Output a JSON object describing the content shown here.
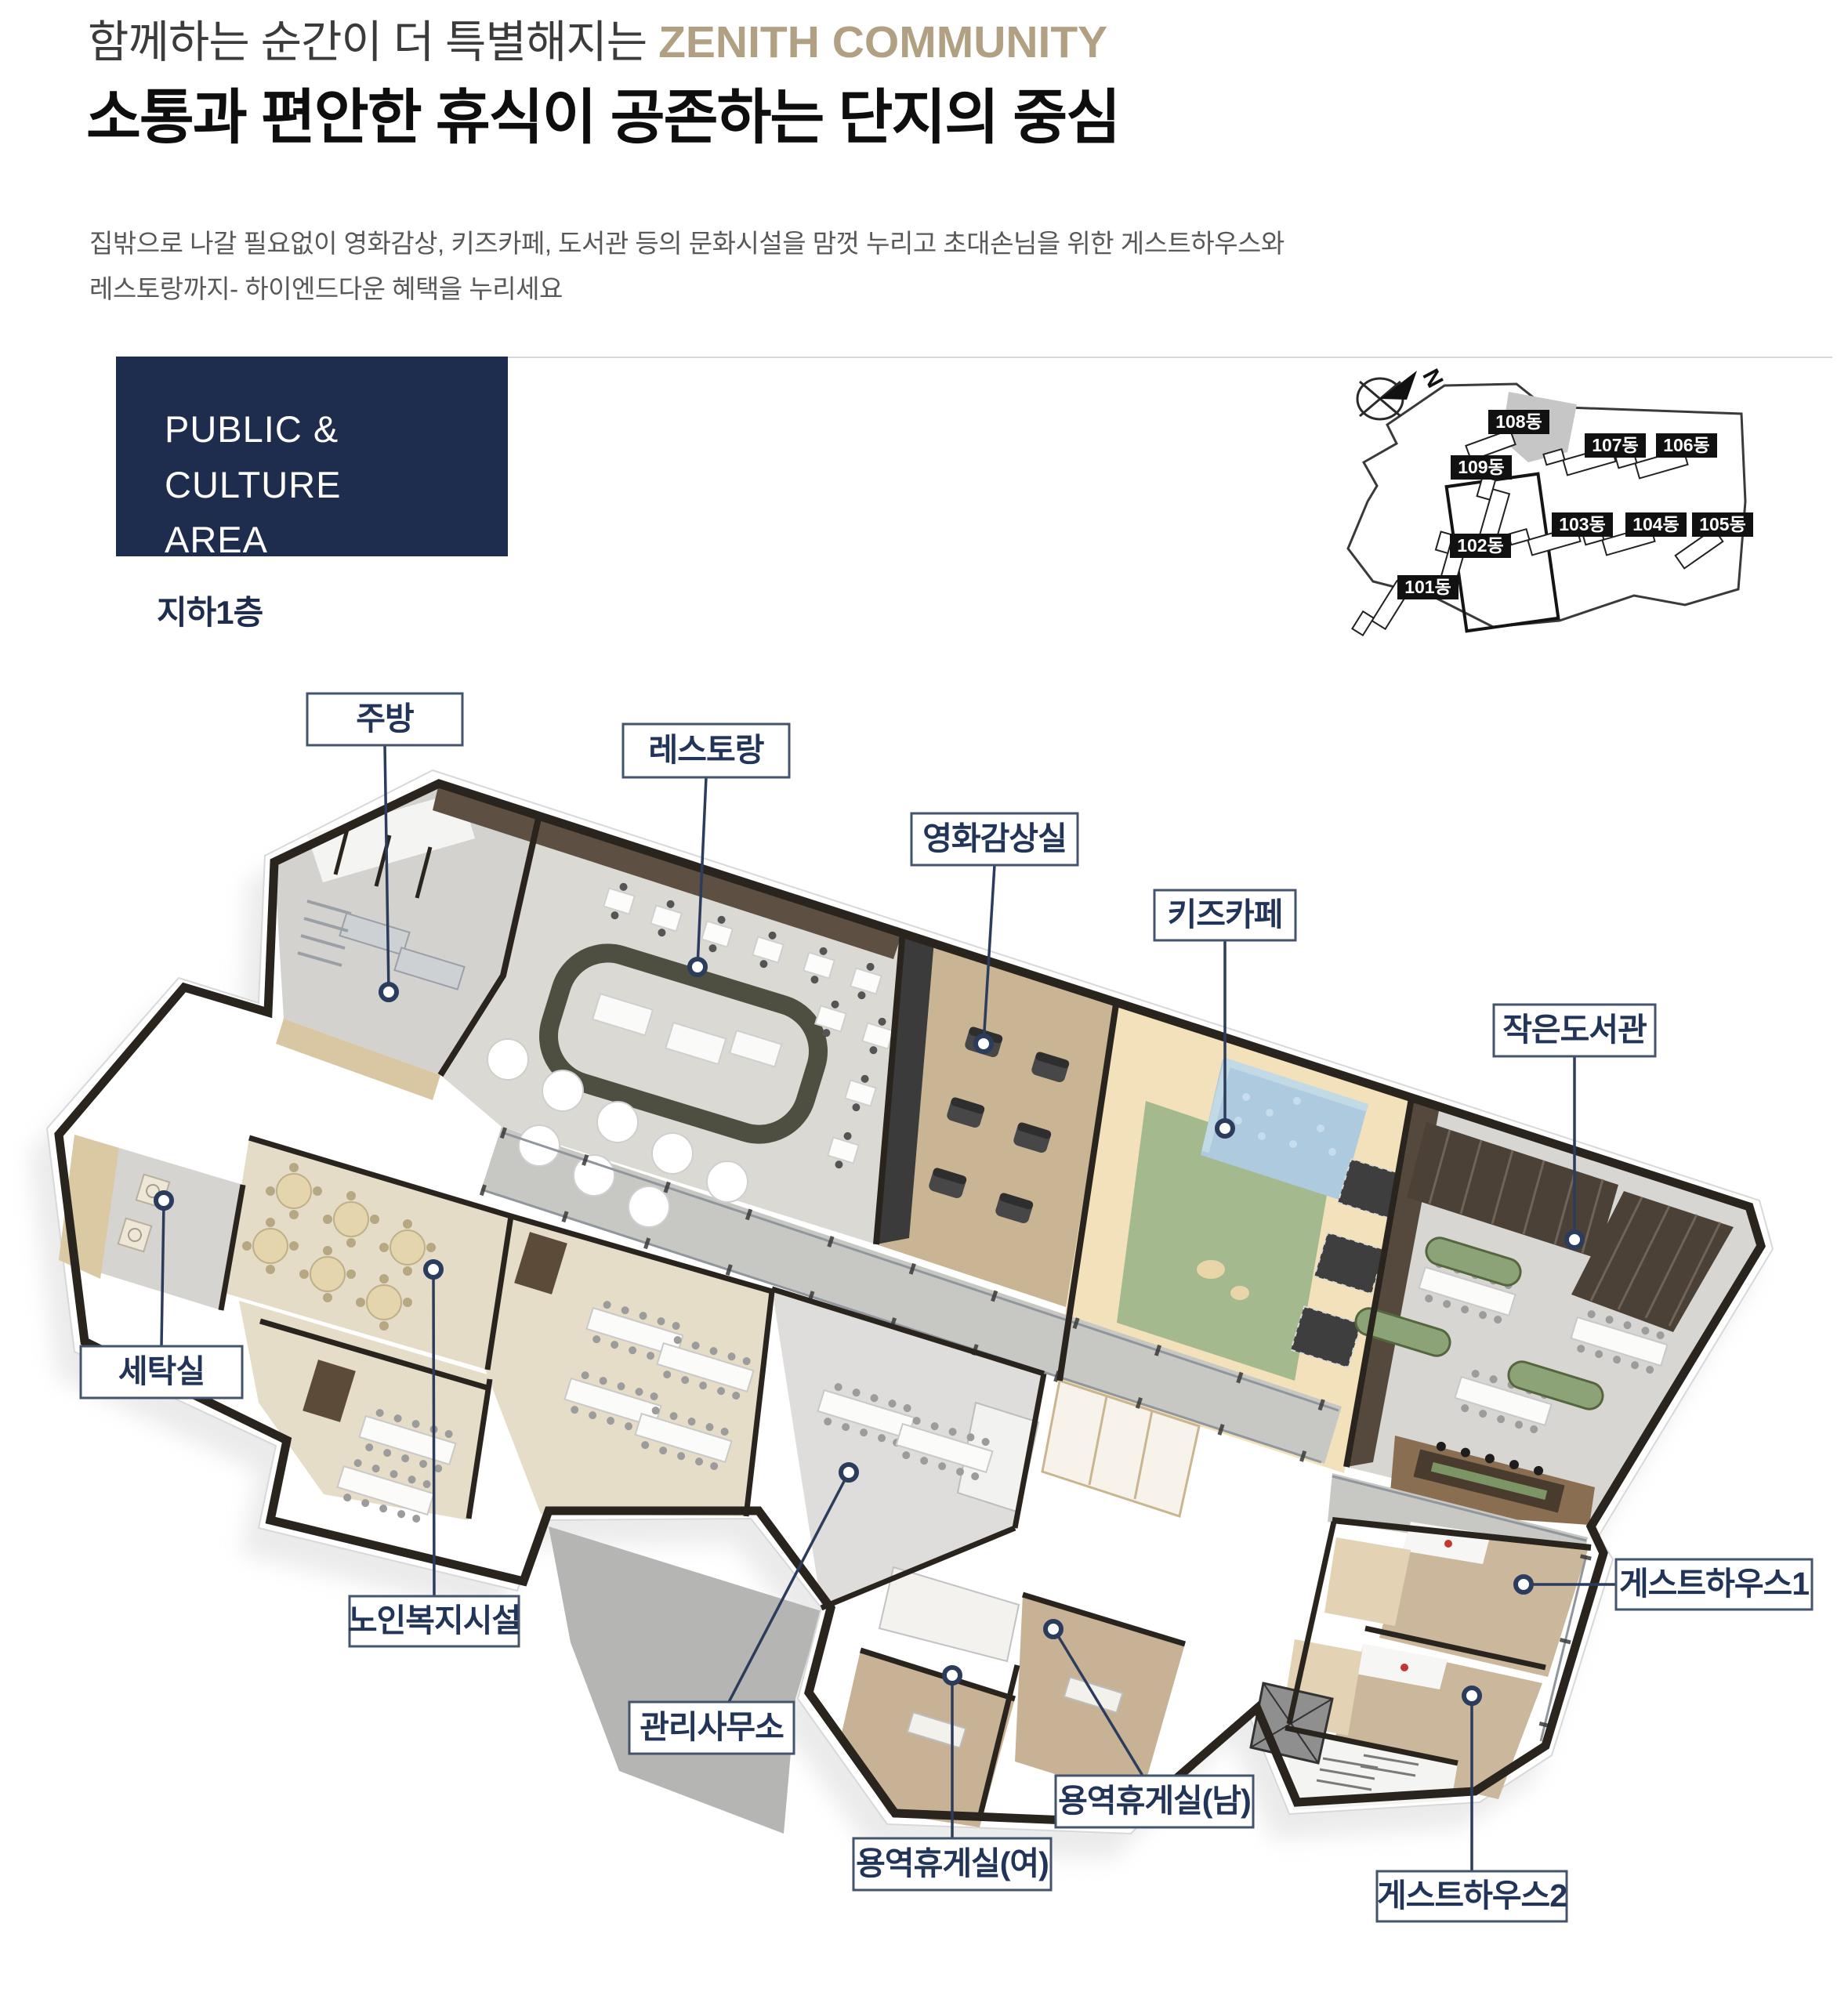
{
  "header": {
    "eyebrow": "함께하는 순간이 더 특별해지는 ",
    "brand": "ZENITH COMMUNITY",
    "title": "소통과 편안한 휴식이 공존하는 단지의 중심",
    "description_line1": "집밖으로 나갈 필요없이 영화감상, 키즈카페, 도서관 등의 문화시설을 맘껏 누리고 초대손님을 위한 게스트하우스와",
    "description_line2": "레스토랑까지- 하이엔드다운 혜택을 누리세요"
  },
  "section": {
    "badge_line1": "PUBLIC & CULTURE",
    "badge_line2": "AREA",
    "floor": "지하1층"
  },
  "sitemap": {
    "compass": "N",
    "buildings": [
      {
        "name": "101동"
      },
      {
        "name": "102동"
      },
      {
        "name": "103동"
      },
      {
        "name": "104동"
      },
      {
        "name": "105동"
      },
      {
        "name": "106동"
      },
      {
        "name": "107동"
      },
      {
        "name": "108동"
      },
      {
        "name": "109동"
      }
    ]
  },
  "floorplan": {
    "labels": [
      {
        "id": "kitchen",
        "text": "주방"
      },
      {
        "id": "restaurant",
        "text": "레스토랑"
      },
      {
        "id": "movie-room",
        "text": "영화감상실"
      },
      {
        "id": "kids-cafe",
        "text": "키즈카페"
      },
      {
        "id": "small-library",
        "text": "작은도서관"
      },
      {
        "id": "laundry",
        "text": "세탁실"
      },
      {
        "id": "senior-welfare",
        "text": "노인복지시설"
      },
      {
        "id": "management-office",
        "text": "관리사무소"
      },
      {
        "id": "service-lounge-women",
        "text": "용역휴게실(여)"
      },
      {
        "id": "service-lounge-men",
        "text": "용역휴게실(남)"
      },
      {
        "id": "guesthouse-1",
        "text": "게스트하우스1"
      },
      {
        "id": "guesthouse-2",
        "text": "게스트하우스2"
      }
    ]
  },
  "colors": {
    "badge_navy": "#1e2c4e",
    "brand_tan": "#b2a083",
    "label_navy": "#223458",
    "leader_line": "#2c3c5c",
    "kids_green": "#a5b98f",
    "ballpit_blue": "#adcade",
    "wood_floor": "#c9b493",
    "kids_cream": "#f2e1ba"
  }
}
